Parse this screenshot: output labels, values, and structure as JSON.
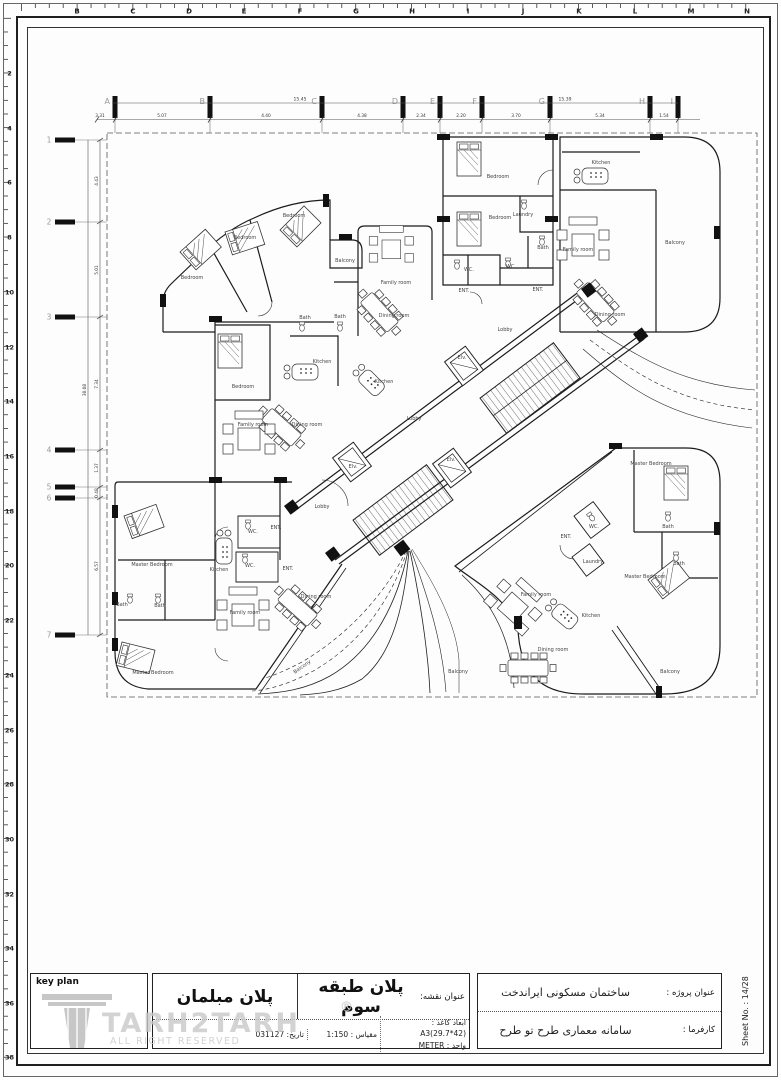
{
  "ruler": {
    "top_letters": [
      {
        "l": "B",
        "x": 77
      },
      {
        "l": "C",
        "x": 133
      },
      {
        "l": "D",
        "x": 189
      },
      {
        "l": "E",
        "x": 244
      },
      {
        "l": "F",
        "x": 300
      },
      {
        "l": "G",
        "x": 356
      },
      {
        "l": "H",
        "x": 412
      },
      {
        "l": "I",
        "x": 468
      },
      {
        "l": "J",
        "x": 523
      },
      {
        "l": "K",
        "x": 579
      },
      {
        "l": "L",
        "x": 635
      },
      {
        "l": "M",
        "x": 691
      },
      {
        "l": "N",
        "x": 747
      }
    ],
    "left_numbers": [
      {
        "l": "2",
        "y": 73
      },
      {
        "l": "4",
        "y": 128
      },
      {
        "l": "6",
        "y": 182
      },
      {
        "l": "8",
        "y": 237
      },
      {
        "l": "10",
        "y": 292
      },
      {
        "l": "12",
        "y": 347
      },
      {
        "l": "14",
        "y": 401
      },
      {
        "l": "16",
        "y": 456
      },
      {
        "l": "18",
        "y": 511
      },
      {
        "l": "20",
        "y": 565
      },
      {
        "l": "22",
        "y": 620
      },
      {
        "l": "24",
        "y": 675
      },
      {
        "l": "26",
        "y": 730
      },
      {
        "l": "28",
        "y": 784
      },
      {
        "l": "30",
        "y": 839
      },
      {
        "l": "32",
        "y": 894
      },
      {
        "l": "34",
        "y": 948
      },
      {
        "l": "36",
        "y": 1003
      },
      {
        "l": "38",
        "y": 1057
      }
    ]
  },
  "plan": {
    "grid_columns": [
      {
        "label": "A",
        "x": 115
      },
      {
        "label": "B",
        "x": 210
      },
      {
        "label": "C",
        "x": 322
      },
      {
        "label": "D",
        "x": 403
      },
      {
        "label": "E",
        "x": 440
      },
      {
        "label": "F",
        "x": 482
      },
      {
        "label": "G",
        "x": 550
      },
      {
        "label": "H",
        "x": 650
      },
      {
        "label": "I",
        "x": 678
      }
    ],
    "grid_rows": [
      {
        "label": "1",
        "y": 140
      },
      {
        "label": "2",
        "y": 222
      },
      {
        "label": "3",
        "y": 317
      },
      {
        "label": "4",
        "y": 450
      },
      {
        "label": "5",
        "y": 487
      },
      {
        "label": "6",
        "y": 498
      },
      {
        "label": "7",
        "y": 635
      }
    ],
    "dim_top": {
      "totals": [
        {
          "t": "15.45",
          "x": 300
        },
        {
          "t": "15.39",
          "x": 565
        }
      ],
      "segments": [
        {
          "t": "3.31",
          "x": 100
        },
        {
          "t": "5.07",
          "x": 162
        },
        {
          "t": "4.40",
          "x": 266
        },
        {
          "t": "4.38",
          "x": 362
        },
        {
          "t": "2.34",
          "x": 421
        },
        {
          "t": "2.20",
          "x": 461
        },
        {
          "t": "3.70",
          "x": 516
        },
        {
          "t": "5.34",
          "x": 600
        },
        {
          "t": "1.54",
          "x": 664
        }
      ]
    },
    "dim_left": {
      "total": {
        "t": "30.08",
        "y": 390
      },
      "segments": [
        {
          "t": "4.43",
          "y": 181
        },
        {
          "t": "5.01",
          "y": 270
        },
        {
          "t": "7.34",
          "y": 384
        },
        {
          "t": "1.37",
          "y": 468
        },
        {
          "t": "0.48",
          "y": 493
        },
        {
          "t": "6.57",
          "y": 566
        }
      ]
    },
    "room_labels": [
      {
        "t": "Bedroom",
        "x": 192,
        "y": 279
      },
      {
        "t": "Bedroom",
        "x": 245,
        "y": 239
      },
      {
        "t": "Bedroom",
        "x": 294,
        "y": 217
      },
      {
        "t": "Balcony",
        "x": 345,
        "y": 262
      },
      {
        "t": "Family room",
        "x": 396,
        "y": 284
      },
      {
        "t": "Dining room",
        "x": 394,
        "y": 317
      },
      {
        "t": "Bedroom",
        "x": 498,
        "y": 178
      },
      {
        "t": "Bedroom",
        "x": 500,
        "y": 219
      },
      {
        "t": "Laundry",
        "x": 523,
        "y": 216
      },
      {
        "t": "Bath",
        "x": 543,
        "y": 249
      },
      {
        "t": "WC.",
        "x": 469,
        "y": 271
      },
      {
        "t": "WC.",
        "x": 511,
        "y": 268
      },
      {
        "t": "ENT.",
        "x": 464,
        "y": 292
      },
      {
        "t": "ENT.",
        "x": 538,
        "y": 291
      },
      {
        "t": "Kitchen",
        "x": 601,
        "y": 164
      },
      {
        "t": "Family room",
        "x": 578,
        "y": 251
      },
      {
        "t": "Balcony",
        "x": 675,
        "y": 244
      },
      {
        "t": "Dining room",
        "x": 610,
        "y": 316
      },
      {
        "t": "Lobby",
        "x": 505,
        "y": 331
      },
      {
        "t": "Bath",
        "x": 305,
        "y": 319
      },
      {
        "t": "Bath",
        "x": 340,
        "y": 318
      },
      {
        "t": "Kitchen",
        "x": 322,
        "y": 363
      },
      {
        "t": "Kitchen",
        "x": 384,
        "y": 383
      },
      {
        "t": "Bedroom",
        "x": 243,
        "y": 388
      },
      {
        "t": "Family room",
        "x": 253,
        "y": 426
      },
      {
        "t": "Dining room",
        "x": 307,
        "y": 426
      },
      {
        "t": "Lobby",
        "x": 414,
        "y": 420
      },
      {
        "t": "Elv.",
        "x": 462,
        "y": 359
      },
      {
        "t": "Elv.",
        "x": 353,
        "y": 468
      },
      {
        "t": "Elv.",
        "x": 451,
        "y": 461
      },
      {
        "t": "Lobby",
        "x": 322,
        "y": 508
      },
      {
        "t": "Master Bedroom",
        "x": 152,
        "y": 566
      },
      {
        "t": "Kitchen",
        "x": 219,
        "y": 571
      },
      {
        "t": "WC.",
        "x": 253,
        "y": 533
      },
      {
        "t": "WC.",
        "x": 250,
        "y": 567
      },
      {
        "t": "ENT.",
        "x": 276,
        "y": 529
      },
      {
        "t": "ENT.",
        "x": 288,
        "y": 570
      },
      {
        "t": "Bath",
        "x": 122,
        "y": 606
      },
      {
        "t": "Bath",
        "x": 160,
        "y": 607
      },
      {
        "t": "Family room",
        "x": 245,
        "y": 614
      },
      {
        "t": "Dining room",
        "x": 316,
        "y": 598
      },
      {
        "t": "Master Bedroom",
        "x": 153,
        "y": 674
      },
      {
        "t": "Balcony",
        "x": 303,
        "y": 668,
        "r": -35
      },
      {
        "t": "Master Bedroom",
        "x": 651,
        "y": 465
      },
      {
        "t": "WC.",
        "x": 594,
        "y": 528
      },
      {
        "t": "ENT.",
        "x": 566,
        "y": 538
      },
      {
        "t": "Laundry",
        "x": 593,
        "y": 563
      },
      {
        "t": "Bath",
        "x": 668,
        "y": 528
      },
      {
        "t": "Bath",
        "x": 679,
        "y": 565
      },
      {
        "t": "Master Bedroom",
        "x": 645,
        "y": 578
      },
      {
        "t": "Family room",
        "x": 536,
        "y": 596
      },
      {
        "t": "Kitchen",
        "x": 591,
        "y": 617
      },
      {
        "t": "Dining room",
        "x": 553,
        "y": 651
      },
      {
        "t": "Balcony",
        "x": 458,
        "y": 673
      },
      {
        "t": "Balcony",
        "x": 670,
        "y": 673
      }
    ]
  },
  "titleblock": {
    "keyplan_label": "key plan",
    "brand": "TARH2TARH",
    "registered": "®",
    "rights": "ALL RIGHT RESERVED",
    "map_label": "عنوان نقشه:",
    "map_title": "پلان طبقه سوم",
    "furniture_title": "پلان مبلمان",
    "paper_label": "ابعاد کاغذ :",
    "paper_value": "A3(29.7*42)",
    "unit_label": "واحد :",
    "unit_value": "METER",
    "scale_label": "مقیاس :",
    "scale_value": "1:150",
    "date_label": "تاریخ:",
    "date_value": "031127",
    "project_label": "عنوان پروژه :",
    "project_value": "ساختمان مسکونی ایراندخت",
    "client_label": "کارفرما :",
    "client_value": "سامانه معماری طرح تو طرح",
    "sheet_no": "Sheet No. : 14/28"
  }
}
